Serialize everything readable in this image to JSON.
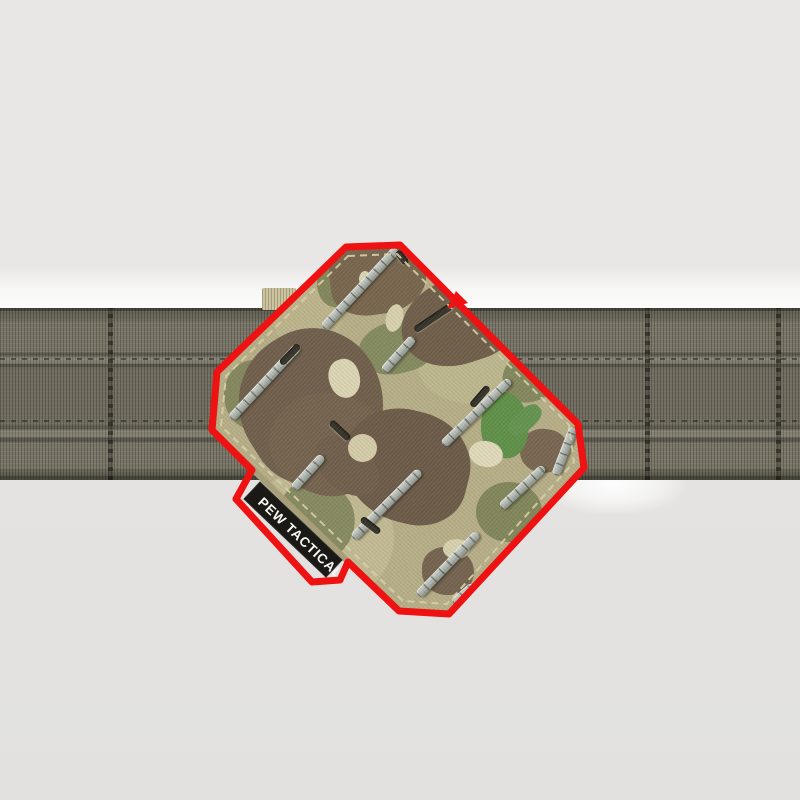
{
  "tag": {
    "label": "PEW TACTICAL",
    "bg": "#1a1915",
    "text_color": "#f7f7f4"
  },
  "annotation": {
    "outline_color": "#ee1212",
    "arrow_icon": "red-arrow-marker"
  },
  "palette": {
    "background": "#e8e7e5",
    "background_bottom": "#e2e1df",
    "backdrop_highlight": "#fbfbfa",
    "belt": "#7a7668",
    "belt_shadow": "#55534a",
    "camo_base": "#b6ae87",
    "camo_brown": "#6f5e4b",
    "camo_olive": "#83875c",
    "camo_bright_green": "#5e9048",
    "camo_cream": "#dcd5b3",
    "slot_silver": "#adb4ad",
    "slot_dark": "#35332a"
  }
}
